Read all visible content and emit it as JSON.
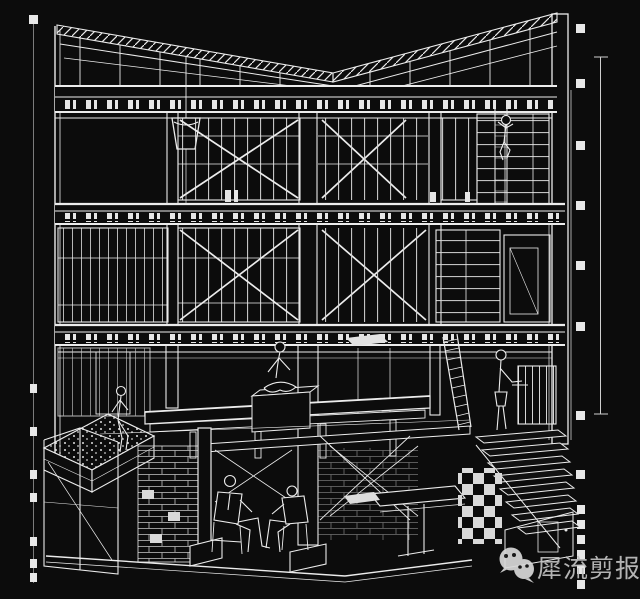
{
  "canvas": {
    "width": 640,
    "height": 599,
    "background": "#0c0c0c",
    "line_color": "#ececec"
  },
  "watermark": {
    "text": "犀流剪报",
    "color": "#c2c2c2",
    "icons": [
      "wechat-logo-large",
      "wechat-logo-small"
    ]
  }
}
